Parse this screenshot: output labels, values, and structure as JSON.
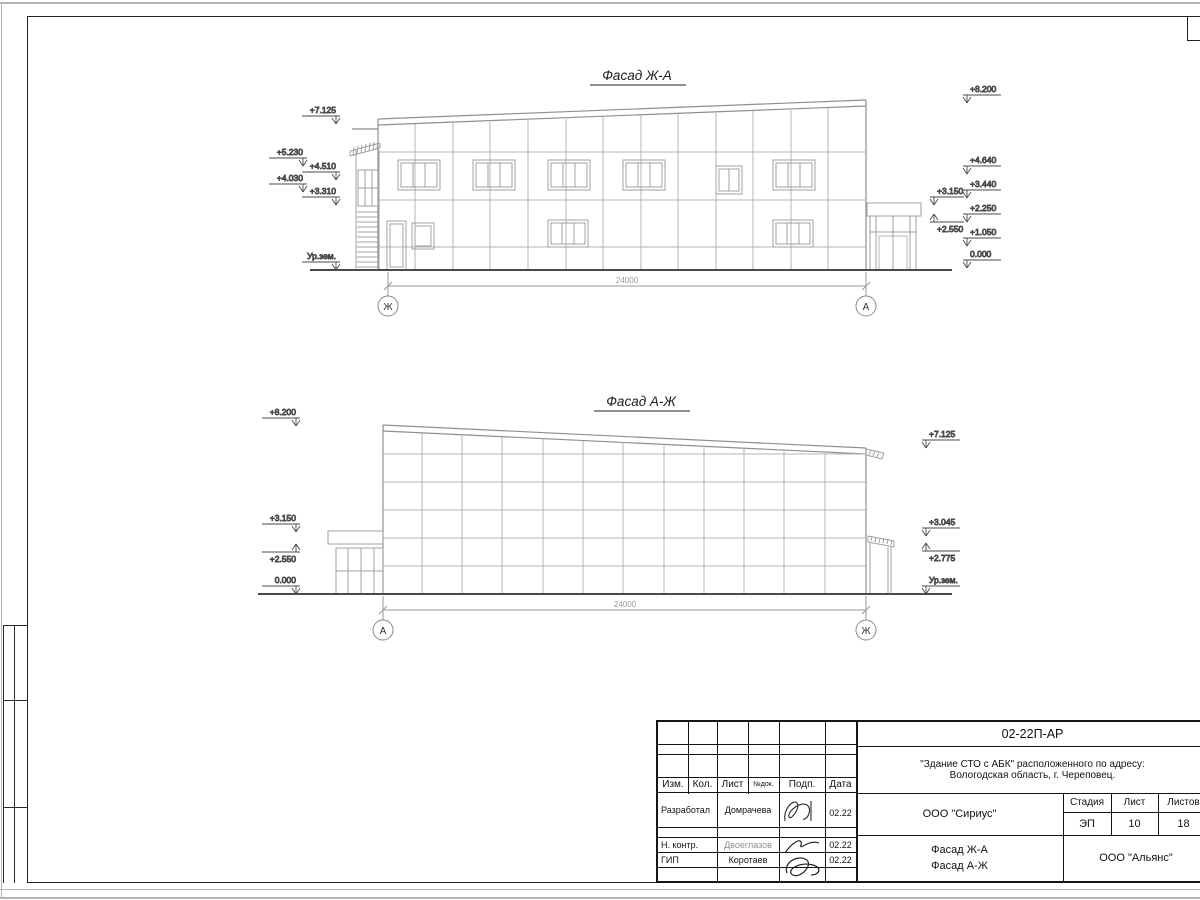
{
  "drawing": {
    "facade_top": {
      "title": "Фасад Ж-А",
      "left_marks": [
        "+7.125",
        "+5.230",
        "+4.510",
        "+4.030",
        "+3.310",
        "Ур.зем."
      ],
      "right_marks": [
        "+8.200",
        "+4.640",
        "+3.440",
        "+3.150",
        "+2.250",
        "+2.550",
        "+1.050",
        "0.000"
      ],
      "dim": "24000",
      "axis_left": "Ж",
      "axis_right": "А"
    },
    "facade_bottom": {
      "title": "Фасад А-Ж",
      "left_marks": [
        "+8.200",
        "+3.150",
        "+2.550",
        "0.000"
      ],
      "right_marks": [
        "+7.125",
        "+3.045",
        "+2.775",
        "Ур.зем."
      ],
      "dim": "24000",
      "axis_left": "А",
      "axis_right": "Ж"
    }
  },
  "titleblock": {
    "doc_code": "02-22П-АР",
    "project_line1": "\"Здание СТО с АБК\" расположенного по адресу:",
    "project_line2": "Вологодская область, г. Череповец.",
    "designer_org": "ООО \"Сириус\"",
    "client_org": "ООО \"Альянс\"",
    "content_line1": "Фасад Ж-А",
    "content_line2": "Фасад А-Ж",
    "stage_label": "Стадия",
    "sheet_label": "Лист",
    "sheets_label": "Листов",
    "stage": "ЭП",
    "sheet": "10",
    "sheets": "18",
    "columns": [
      "Изм.",
      "Кол.",
      "Лист",
      "№док.",
      "Подп.",
      "Дата"
    ],
    "rows": [
      {
        "role": "Разработал",
        "name": "Домрачева",
        "date": "02.22"
      },
      {
        "role": "Н. контр.",
        "name": "Двоеглазов",
        "date": "02.22"
      },
      {
        "role": "ГИП",
        "name": "Коротаев",
        "date": "02.22"
      }
    ]
  }
}
